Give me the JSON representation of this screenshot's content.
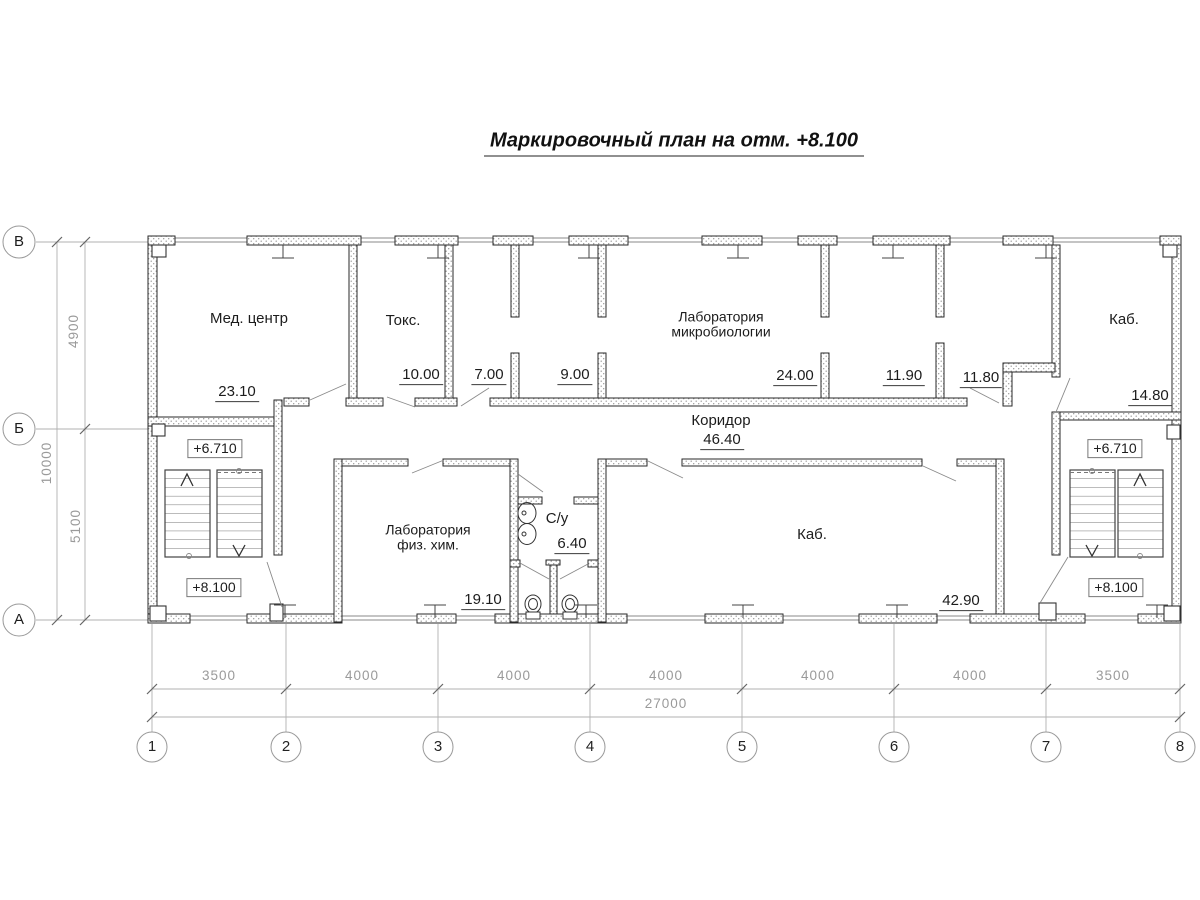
{
  "title": "Маркировочный план на отм. +8.100",
  "rooms": {
    "med_center": {
      "name": "Мед. центр",
      "area": "23.10"
    },
    "toks": {
      "name": "Токс.",
      "area": "10.00"
    },
    "room_7": {
      "area": "7.00"
    },
    "room_9": {
      "area": "9.00"
    },
    "lab_micro": {
      "name_line1": "Лаборатория",
      "name_line2": "микробиологии",
      "area": "24.00"
    },
    "room_11_90": {
      "area": "11.90"
    },
    "room_11_80": {
      "area": "11.80"
    },
    "kab_top": {
      "name": "Каб.",
      "area": "14.80"
    },
    "corridor": {
      "name": "Коридор",
      "area": "46.40"
    },
    "lab_fiz_him": {
      "name_line1": "Лаборатория",
      "name_line2": "физ. хим.",
      "area": "19.10"
    },
    "su": {
      "name": "С/у",
      "area": "6.40"
    },
    "kab_bottom": {
      "name": "Каб.",
      "area": "42.90"
    }
  },
  "stairwells": {
    "left": {
      "upper_elevation": "+6.710",
      "lower_elevation": "+8.100"
    },
    "right": {
      "upper_elevation": "+6.710",
      "lower_elevation": "+8.100"
    }
  },
  "axes": {
    "letters": [
      "В",
      "Б",
      "А"
    ],
    "numbers": [
      "1",
      "2",
      "3",
      "4",
      "5",
      "6",
      "7",
      "8"
    ]
  },
  "dimensions": {
    "vertical": [
      "4900",
      "5100",
      "10000"
    ],
    "horizontal": [
      "3500",
      "4000",
      "4000",
      "4000",
      "4000",
      "4000",
      "3500"
    ],
    "total": "27000"
  }
}
